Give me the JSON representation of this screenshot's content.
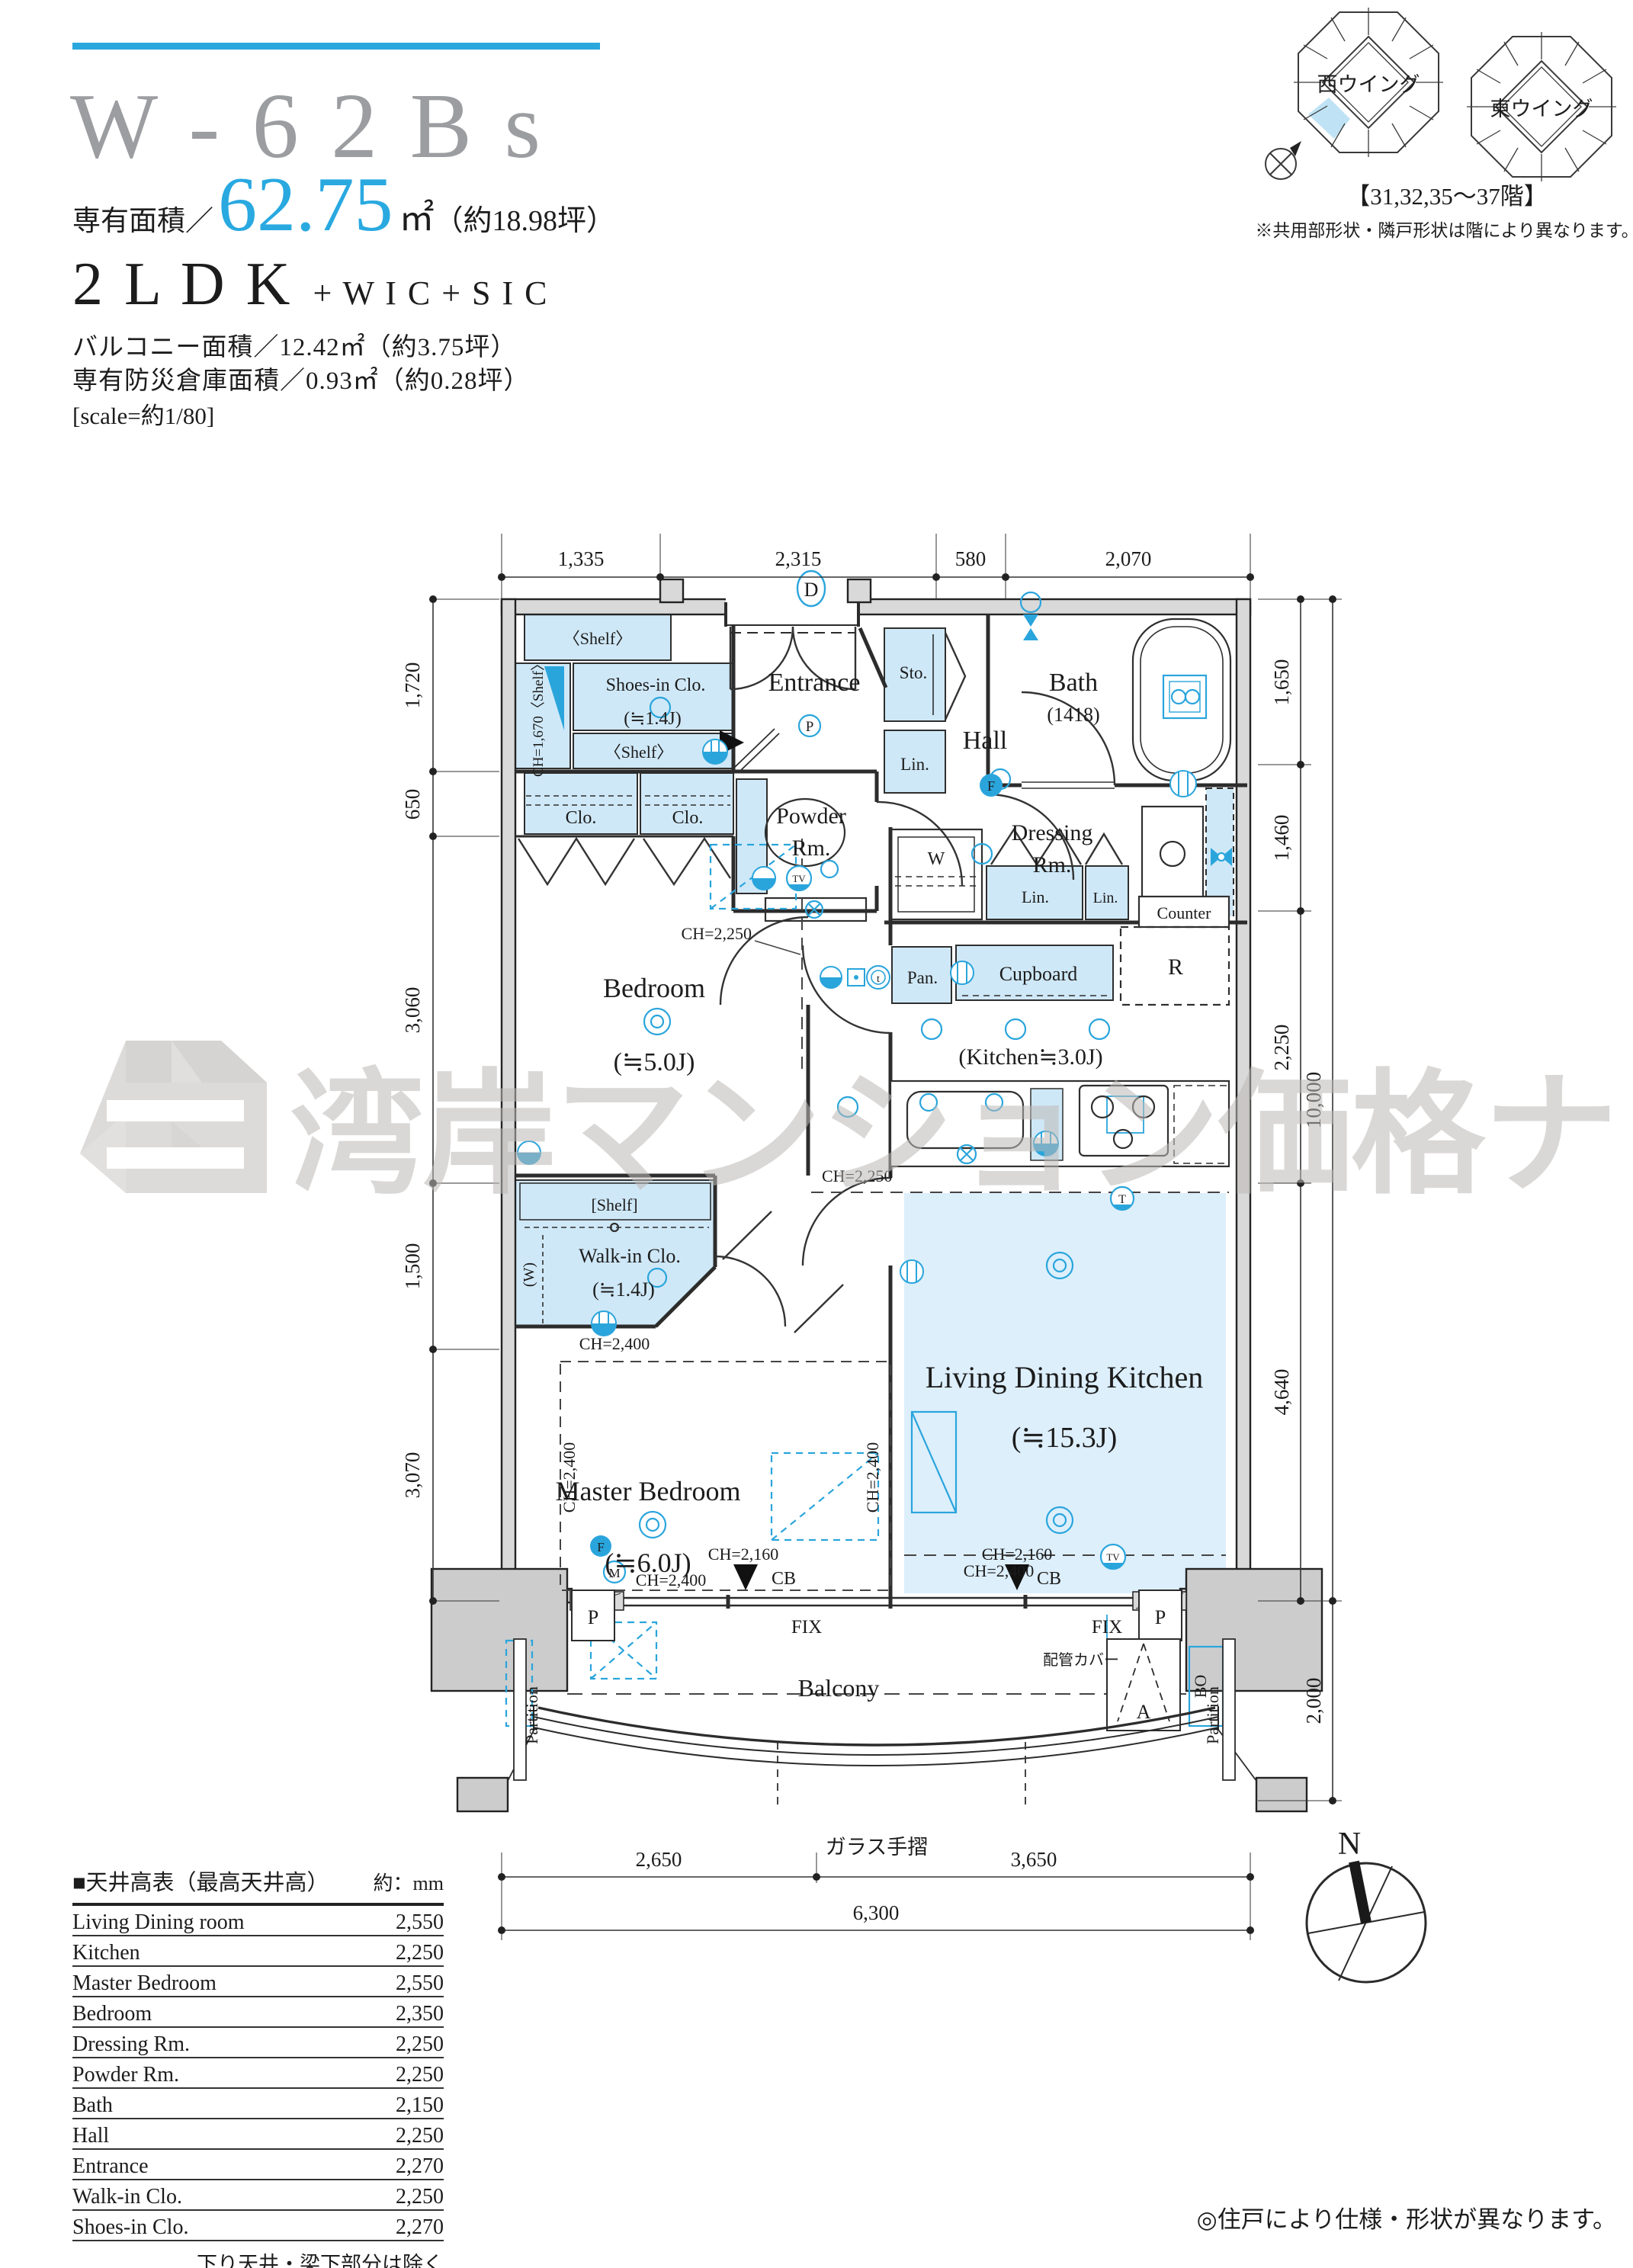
{
  "header": {
    "title": "W - 6 2 B s",
    "area_label": "専有面積／",
    "area_value": "62.75",
    "area_unit": "㎡",
    "area_tsubo": "（約18.98坪）",
    "layout": "2 L D K",
    "layout_suffix": "+ W I C + S I C",
    "balcony_area": "バルコニー面積／12.42㎡（約3.75坪）",
    "disaster_storage": "専有防災倉庫面積／0.93㎡（約0.28坪）",
    "scale_note": "[scale=約1/80]"
  },
  "wings": {
    "west_label": "西ウイング",
    "east_label": "東ウイング",
    "floors": "【31,32,35〜37階】",
    "note": "※共用部形状・隣戸形状は階により異なります。"
  },
  "watermark": {
    "text": "湾岸マンション価格ナビ"
  },
  "plan": {
    "rooms": {
      "entrance": "Entrance",
      "shoes_in_clo": "Shoes-in Clo.",
      "shoes_in_clo_size": "(≒1.4J)",
      "shelf_angle": "〈Shelf〉",
      "shelf_ch": "CH=1,670〈Shelf〉",
      "shelf_bracket": "[Shelf]",
      "clo": "Clo.",
      "powder_line1": "Powder",
      "powder_line2": "Rm.",
      "hall": "Hall",
      "sto": "Sto.",
      "bath": "Bath",
      "bath_size": "(1418)",
      "lin": "Lin.",
      "dressing_line1": "Dressing",
      "dressing_line2": "Rm.",
      "counter": "Counter",
      "washer": "W",
      "pan": "Pan.",
      "cupboard": "Cupboard",
      "fridge": "R",
      "kitchen": "(Kitchen≒3.0J)",
      "bedroom": "Bedroom",
      "bedroom_size": "(≒5.0J)",
      "walk_in_clo": "Walk-in Clo.",
      "walk_in_clo_size": "(≒1.4J)",
      "walk_in_w": "(W)",
      "master_bedroom": "Master Bedroom",
      "master_bedroom_size": "(≒6.0J)",
      "ldk": "Living Dining Kitchen",
      "ldk_size": "(≒15.3J)",
      "balcony": "Balcony"
    },
    "labels": {
      "ch2250": "CH=2,250",
      "ch2400": "CH=2,400",
      "ch2160": "CH=2,160",
      "cb": "CB",
      "fix": "FIX",
      "bo": "BO",
      "pipe_cover": "配管カバー",
      "partition": "Partition",
      "glass_rail": "ガラス手摺",
      "hatch": "A",
      "pillar": "P",
      "icon_d": "D",
      "icon_f": "F",
      "icon_m": "M",
      "icon_p": "P",
      "icon_t": "t",
      "icon_t2": "T",
      "icon_tv": "TV"
    }
  },
  "dimensions": {
    "top": [
      "1,335",
      "2,315",
      "580",
      "2,070"
    ],
    "left": [
      "1,720",
      "650",
      "3,060",
      "1,500",
      "3,070"
    ],
    "right": [
      "1,650",
      "1,460",
      "2,250",
      "4,640"
    ],
    "right_total": "10,000",
    "balcony_depth": "2,000",
    "bottom": [
      "2,650",
      "3,650"
    ],
    "bottom_total": "6,300"
  },
  "table": {
    "title": "■天井高表（最高天井高）",
    "unit": "約：mm",
    "rows": [
      {
        "label": "Living Dining room",
        "value": "2,550"
      },
      {
        "label": "Kitchen",
        "value": "2,250"
      },
      {
        "label": "Master Bedroom",
        "value": "2,550"
      },
      {
        "label": "Bedroom",
        "value": "2,350"
      },
      {
        "label": "Dressing Rm.",
        "value": "2,250"
      },
      {
        "label": "Powder Rm.",
        "value": "2,250"
      },
      {
        "label": "Bath",
        "value": "2,150"
      },
      {
        "label": "Hall",
        "value": "2,250"
      },
      {
        "label": "Entrance",
        "value": "2,270"
      },
      {
        "label": "Walk-in Clo.",
        "value": "2,250"
      },
      {
        "label": "Shoes-in Clo.",
        "value": "2,270"
      }
    ],
    "footnote": "下り天井・梁下部分は除く"
  },
  "compass": {
    "north": "N"
  },
  "footer_note": "◎住戸により仕様・形状が異なります。",
  "colors": {
    "accent": "#2aa5dc",
    "teal_rule": "#2aa7dc",
    "area_value": "#29a9e0",
    "title_gray": "#9c9da0",
    "room_fill": "#cfe8f7",
    "ldk_fill": "#ddeffb",
    "wall_gray": "#d9d9d9",
    "watermark_gray": "#bdbab7"
  }
}
